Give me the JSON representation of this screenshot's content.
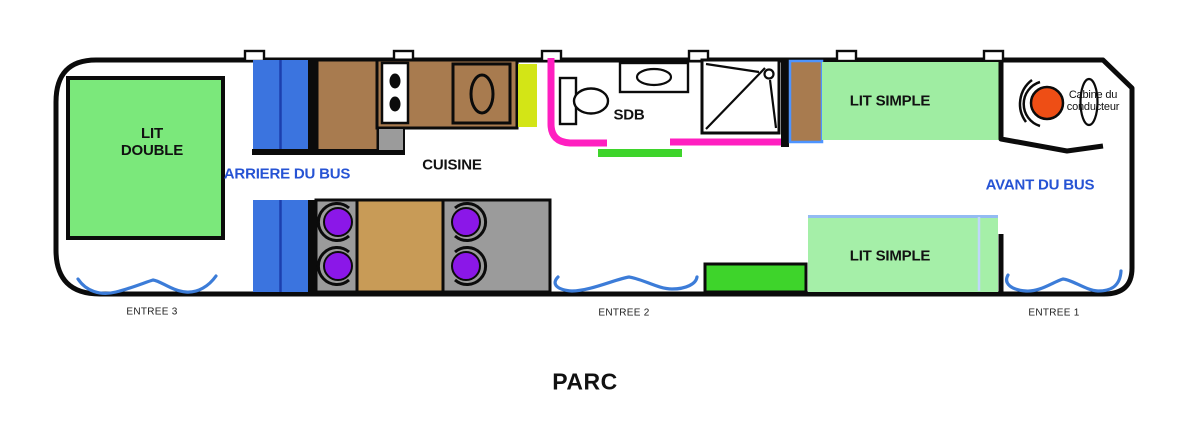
{
  "diagram": {
    "type": "bus-conversion-floor-plan",
    "title": "PARC"
  },
  "labels": {
    "lit_double": "LIT\nDOUBLE",
    "arriere_du_bus": "ARRIERE DU BUS",
    "cuisine": "CUISINE",
    "sdb": "SDB",
    "lit_simple_top": "LIT SIMPLE",
    "lit_simple_bottom": "LIT SIMPLE",
    "cabine_conducteur": "Cabine du\nconducteur",
    "avant_du_bus": "AVANT DU BUS",
    "entree_1": "ENTREE 1",
    "entree_2": "ENTREE 2",
    "entree_3": "ENTREE 3",
    "parc": "PARC"
  },
  "furniture": [
    "double bed (rear)",
    "blue cabinets (rear, upper and lower)",
    "kitchen counter with 2-burner stove and sink",
    "yellow-green worktop",
    "bathroom with toilet, washbasin and shower",
    "green door mat / step",
    "brown wardrobe",
    "single bed (upper, front)",
    "dinette: table with 4 purple seats",
    "green step block",
    "single bed (lower, front)",
    "driver cab with steering wheel and driver seat",
    "3 entrance door swings (blue waves)",
    "6 roof vents on top wall"
  ],
  "colors": {
    "outline_black": "#0b0b0b",
    "cabinet_blue": "#3B74DF",
    "cabinet_blue_divider": "#1C3FAE",
    "wood_brown": "#A87B4F",
    "table_tan": "#C89B57",
    "floor_gray": "#9B9B9B",
    "seat_purple": "#8B17E8",
    "worktop_yellow_green": "#D3E516",
    "bathroom_pink": "#FF1FC0",
    "step_green": "#3ED42B",
    "double_bed_green": "#7BE87B",
    "single_bed_green": "#9FEDA2",
    "bed_border_light_blue": "#93BBF2",
    "wardrobe_border_blue": "#4D94FF",
    "steering_orange": "#EE4E15",
    "label_blue": "#2653D4",
    "door_wave_blue": "#3C7CD8"
  }
}
